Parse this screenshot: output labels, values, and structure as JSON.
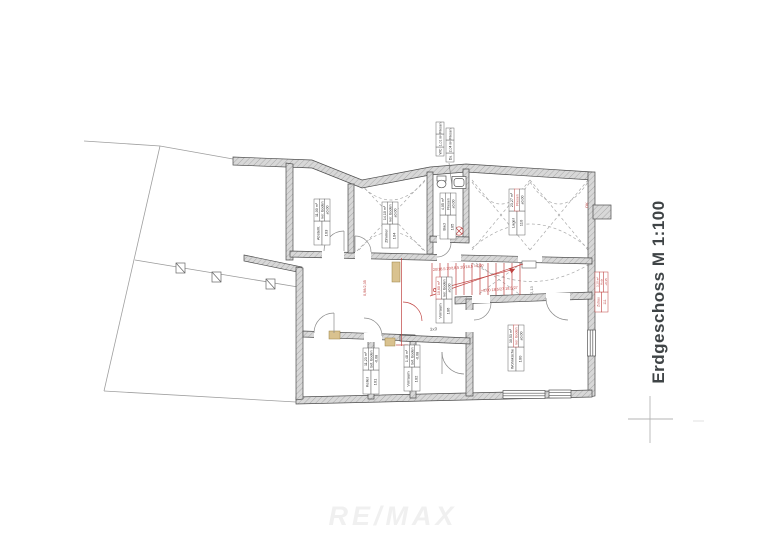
{
  "page": {
    "title": "Erdgeschoss M 1:100",
    "watermark": "RE/MAX"
  },
  "rooms": [
    {
      "name": "Abstellr.",
      "number": "103",
      "area": "11,00 m²",
      "floor": "ker. Boden",
      "level": "±0,00"
    },
    {
      "name": "Zimmer",
      "number": "104",
      "area": "14,10 m²",
      "floor": "ker. Boden",
      "level": "±0,00"
    },
    {
      "name": "Bad",
      "number": "105",
      "area": "4,05 m²",
      "floor": "Fliesen",
      "level": "±0,00"
    },
    {
      "name": "Lager",
      "number": "110",
      "area": "23,27 m²",
      "floor": "Fliesen",
      "level": "±0,00"
    },
    {
      "name": "Vorraum",
      "number": "106",
      "area": "10,60 m²",
      "floor": "ker. Boden",
      "level": "±0,00"
    },
    {
      "name": "Wohnküche",
      "number": "100",
      "area": "30,53 m²",
      "floor": "ker. Boden",
      "level": "±0,00"
    },
    {
      "name": "Keller",
      "number": "101",
      "area": "11,23 m²",
      "floor": "bet. Boden",
      "level": "-0,08"
    },
    {
      "name": "Vorraum",
      "number": "102",
      "area": "1,48 m²",
      "floor": "bet. Boden",
      "level": "-0,08"
    },
    {
      "name": "WC",
      "number": "",
      "area": "1,01 m²",
      "floor": "Fliesen",
      "level": "±0,00"
    },
    {
      "name": "Du.",
      "number": "",
      "area": "2,04 m²",
      "floor": "Fliesen",
      "level": "±0,00"
    },
    {
      "name": "Zubau",
      "number": "111",
      "area": "3,10 m²",
      "floor": "Holz",
      "level": "+0,35"
    }
  ],
  "annotations": {
    "stair_note_top": "20/18,5 20/18,5 20/18,5 +0,00",
    "stair_note_bottom": "+0,00 18,5/27 18,5/27",
    "wall_note": "0,98/2,35",
    "dim_note": "3x9",
    "ok_note": "OK",
    "height_note": "2,13"
  }
}
